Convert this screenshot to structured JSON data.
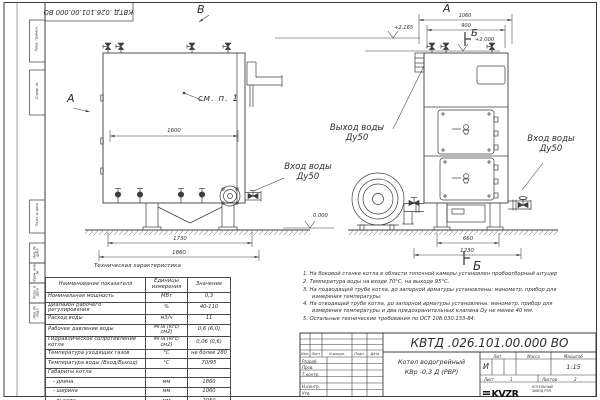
{
  "sheet": {
    "designation": "КВТД .026.101.00.000  ВО"
  },
  "margin_stamps": [
    "Перв. примен.",
    "Справ. №",
    "Подп. и дата",
    "Инв. № дубл.",
    "Взам. инв. №",
    "Подп. и дата",
    "Инв. № подл."
  ],
  "views": {
    "front": {
      "label": "В",
      "arrow_label": "А",
      "see_note": "см. п. 1",
      "dims": {
        "width_inner": "1600",
        "width_supports": "1730",
        "width_total": "1860"
      },
      "elevations": {
        "top": "+2.165",
        "mid": "+2.000",
        "ground": "0.000"
      },
      "inlet_label_line1": "Вход воды",
      "inlet_label_line2": "Ду50"
    },
    "side": {
      "label": "А",
      "section_label": "Б",
      "dims": {
        "width_total": "1060",
        "width_inner": "900",
        "base_inner": "660",
        "base_total": "1230"
      },
      "outlet_label_line1": "Выход воды",
      "outlet_label_line2": "Ду50",
      "inlet_label_line1": "Вход воды",
      "inlet_label_line2": "Ду50"
    }
  },
  "spec_table": {
    "title": "Техническая характеристика",
    "headers": [
      "Наименование показателя",
      "Единицы измерения",
      "Значение"
    ],
    "rows": [
      [
        "Номинальная мощность",
        "МВт",
        "0,3"
      ],
      [
        "Диапазон рабочего регулирования",
        "%",
        "40-110"
      ],
      [
        "Расход воды",
        "м3/ч",
        "11"
      ],
      [
        "Рабочее давление воды",
        "МПа (кгс/см2)",
        "0,6 (6,0)"
      ],
      [
        "Гидравлическое сопротивление котла",
        "МПа (кгс/см2)",
        "0,06 (0,6)"
      ],
      [
        "Температура уходящих газов",
        "°С",
        "не более 280"
      ],
      [
        "Температура воды (Вход/Выход)",
        "°С",
        "70/95"
      ],
      [
        "Габариты котла",
        "",
        ""
      ],
      [
        "   - длина",
        "мм",
        "1860"
      ],
      [
        "   - ширина",
        "мм",
        "1060"
      ],
      [
        "   - высота",
        "мм",
        "2050"
      ]
    ]
  },
  "notes": [
    "1.  На боковой стенке котла в области топочной камеры установлен пробоотборный штуцер",
    "2.  Температура воды на входе 70°С, на выходе 95°С.",
    "3.  На подводящей трубе котла, до запорной арматуры установлены: манометр, прибор для измерения температуры.",
    "4.  На отводящей трубе котла, до запорной арматуры установлены: манометр, прибор для измерения температуры и два предохранительных клапана Dу не менее 40 мм.",
    "5.  Остальные технические требования по ОСТ 108.030.133-84."
  ],
  "title_block": {
    "designation": "КВТД .026.101.00.000  ВО",
    "product_name_line1": "Котел водогрейный",
    "product_name_line2": "КВр -0,3 Д (РВР)",
    "rev_headers": [
      "Изм.",
      "Лист",
      "N докум.",
      "Подп.",
      "Дата"
    ],
    "roles": [
      "Разраб.",
      "Пров.",
      "Т.контр.",
      "Н.контр.",
      "Утв."
    ],
    "lit_label": "Лит.",
    "lit_value": "И",
    "mass_label": "Масса",
    "scale_label": "Масштаб",
    "scale_value": "1:15",
    "sheet_label": "Лист",
    "sheet_value": "1",
    "sheets_label": "Листов",
    "sheets_value": "2",
    "company_logo": "KVZR",
    "company_line1": "КОТЕЛЬНЫЙ",
    "company_line2": "ЗАВОД РЭП",
    "format_label": "Формат",
    "format_value": "А3"
  }
}
